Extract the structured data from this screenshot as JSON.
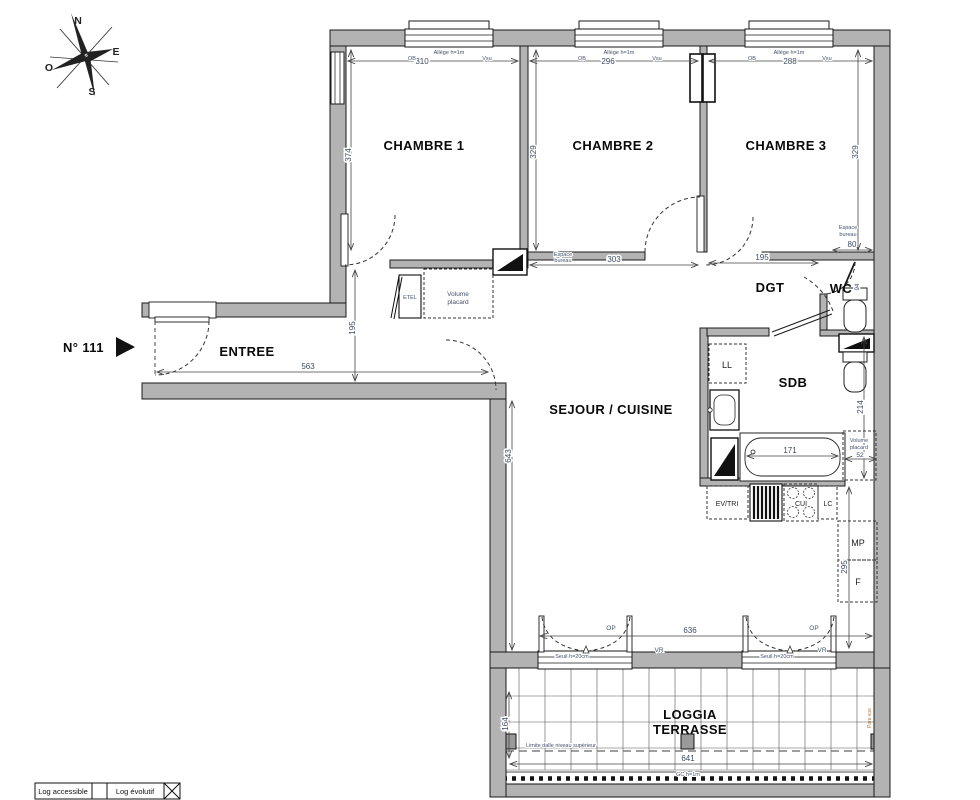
{
  "compass": {
    "n": "N",
    "e": "E",
    "s": "S",
    "o": "O"
  },
  "unit": {
    "number": "N° 111"
  },
  "rooms": {
    "chambre1": "CHAMBRE 1",
    "chambre2": "CHAMBRE 2",
    "chambre3": "CHAMBRE 3",
    "entree": "ENTREE",
    "sejour": "SEJOUR / CUISINE",
    "dgt": "DGT",
    "wc": "WC",
    "sdb": "SDB",
    "loggia_line1": "LOGGIA",
    "loggia_line2": "TERRASSE"
  },
  "dimensions": {
    "chambre1_width": "310",
    "chambre1_height": "374",
    "chambre2_width": "296",
    "chambre2_height": "329",
    "chambre3_width": "288",
    "chambre3_height": "329",
    "corridor": "303",
    "dgt_width": "195",
    "bureau_width": "80",
    "entree_width": "563",
    "entree_height": "195",
    "sejour_height": "643",
    "sejour_width": "636",
    "bath": "171",
    "sdb_height": "214",
    "placard_width": "52",
    "kitchen_height": "295",
    "loggia_height": "164",
    "loggia_width": "641",
    "wc_door": "94"
  },
  "annotations": {
    "allege": "Allège h=1m",
    "ob": "OB",
    "vsu": "Vsu",
    "espace": "Espace",
    "bureau": "bureau",
    "volume": "Volume",
    "placard": "placard",
    "etel": "ETEL",
    "ll": "LL",
    "ev_tri": "EV/TRI",
    "cui": "CUI",
    "lc": "LC",
    "mp": "MP",
    "f": "F",
    "op": "OP",
    "vr": "VR",
    "seuil": "Seuil h=20cm",
    "limite": "Limite dalle niveau supérieur",
    "gc": "GC h=1m",
    "pare_vue": "Pare vue"
  },
  "legend": {
    "accessible": "Log accessible",
    "evolutif": "Log évolutif"
  }
}
